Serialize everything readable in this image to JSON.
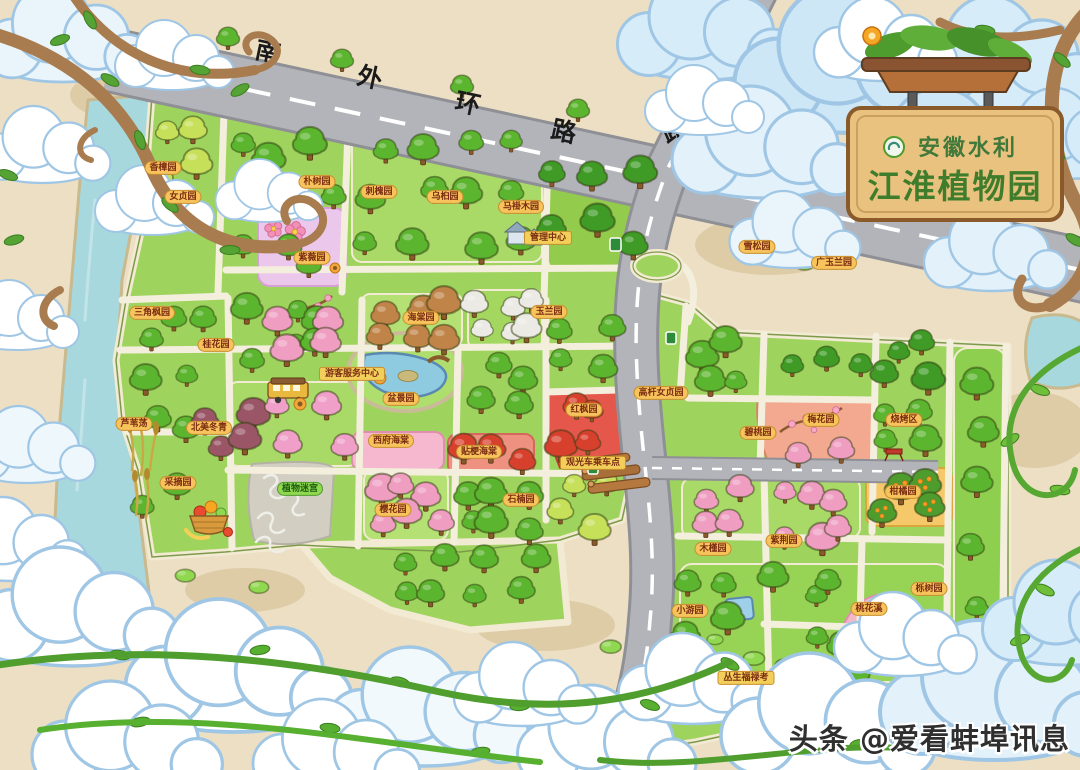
{
  "sign": {
    "org": "安徽水利",
    "title": "江淮植物园"
  },
  "roads": [
    {
      "name": "南外环路"
    },
    {
      "name": "延安路"
    }
  ],
  "watermark": "头条 @爱看蚌埠讯息",
  "map": {
    "labels": [
      {
        "text": "香樟园",
        "x": 163,
        "y": 168
      },
      {
        "text": "女贞园",
        "x": 183,
        "y": 197
      },
      {
        "text": "朴树园",
        "x": 317,
        "y": 182
      },
      {
        "text": "刺槐园",
        "x": 379,
        "y": 192
      },
      {
        "text": "乌桕园",
        "x": 445,
        "y": 197
      },
      {
        "text": "马褂木园",
        "x": 521,
        "y": 207
      },
      {
        "text": "雪松园",
        "x": 757,
        "y": 247
      },
      {
        "text": "广玉兰园",
        "x": 834,
        "y": 263
      },
      {
        "text": "紫薇园",
        "x": 312,
        "y": 258
      },
      {
        "text": "三角枫园",
        "x": 152,
        "y": 313
      },
      {
        "text": "桂花园",
        "x": 216,
        "y": 345
      },
      {
        "text": "海棠园",
        "x": 421,
        "y": 318
      },
      {
        "text": "玉兰园",
        "x": 549,
        "y": 312
      },
      {
        "text": "管理中心",
        "x": 548,
        "y": 238,
        "variant": "bar"
      },
      {
        "text": "游客服务中心",
        "x": 352,
        "y": 374,
        "variant": "bar"
      },
      {
        "text": "盆景园",
        "x": 401,
        "y": 399
      },
      {
        "text": "北美冬青",
        "x": 209,
        "y": 428
      },
      {
        "text": "芦苇荡",
        "x": 134,
        "y": 424
      },
      {
        "text": "采摘园",
        "x": 178,
        "y": 483
      },
      {
        "text": "植物迷宫",
        "x": 300,
        "y": 489,
        "variant": "green"
      },
      {
        "text": "西府海棠",
        "x": 391,
        "y": 441
      },
      {
        "text": "贴梗海棠",
        "x": 479,
        "y": 452
      },
      {
        "text": "红枫园",
        "x": 584,
        "y": 410
      },
      {
        "text": "樱花园",
        "x": 393,
        "y": 510
      },
      {
        "text": "石楠园",
        "x": 521,
        "y": 500
      },
      {
        "text": "高杆女贞园",
        "x": 661,
        "y": 393
      },
      {
        "text": "观光车乘车点",
        "x": 593,
        "y": 463,
        "variant": "bar"
      },
      {
        "text": "梅花园",
        "x": 821,
        "y": 420
      },
      {
        "text": "碧桃园",
        "x": 758,
        "y": 433
      },
      {
        "text": "烧烤区",
        "x": 904,
        "y": 420
      },
      {
        "text": "柑橘园",
        "x": 903,
        "y": 492
      },
      {
        "text": "紫荆园",
        "x": 784,
        "y": 541
      },
      {
        "text": "木槿园",
        "x": 713,
        "y": 549
      },
      {
        "text": "小游园",
        "x": 690,
        "y": 611
      },
      {
        "text": "桃花溪",
        "x": 869,
        "y": 609
      },
      {
        "text": "丛生福禄考",
        "x": 746,
        "y": 678,
        "variant": "bar"
      },
      {
        "text": "栎树园",
        "x": 929,
        "y": 589
      }
    ],
    "icons": {
      "bus": "shuttle-bus-icon",
      "basket": "fruit-basket-icon",
      "maze": "plant-maze",
      "pond": "garden-pond",
      "reeds": "reed-marsh-icon",
      "sunflower": "sunflower-icon",
      "picnic": "picnic-table-icon",
      "road_sign": "road-sign-icon",
      "building": "visitor-center-building"
    }
  },
  "colors": {
    "parkGreen": "#9ed45e",
    "road": "#b3b4ba",
    "river": "#a7d8dd",
    "sand": "#ecdfc4",
    "lavenderZone": "#ecc7ec",
    "redZone": "#e4574a",
    "salmonZone": "#f2a98f",
    "yellowZone": "#f5c96a",
    "pinkZone": "#f6b8ce",
    "signWood": "#eac27f",
    "signText": "#3f7d2c",
    "labelBg": "#f6c35c"
  }
}
